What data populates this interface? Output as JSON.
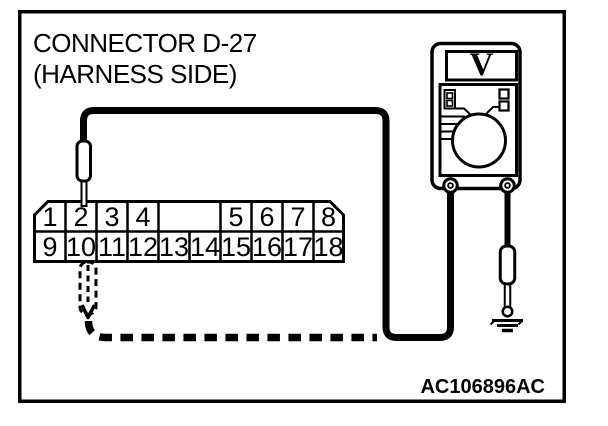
{
  "figure": {
    "title_line1": "CONNECTOR D-27",
    "title_line2": "(HARNESS SIDE)",
    "code": "AC106896AC"
  },
  "connector": {
    "top_row_pins": [
      "1",
      "2",
      "3",
      "4",
      "5",
      "6",
      "7",
      "8"
    ],
    "bottom_row_pins": [
      "9",
      "10",
      "11",
      "12",
      "13",
      "14",
      "15",
      "16",
      "17",
      "18"
    ]
  },
  "meter": {
    "display_label": "V",
    "solid_probe_pin": "2",
    "dashed_probe_pin": "10"
  },
  "colors": {
    "ink": "#000000",
    "paper": "#ffffff"
  }
}
